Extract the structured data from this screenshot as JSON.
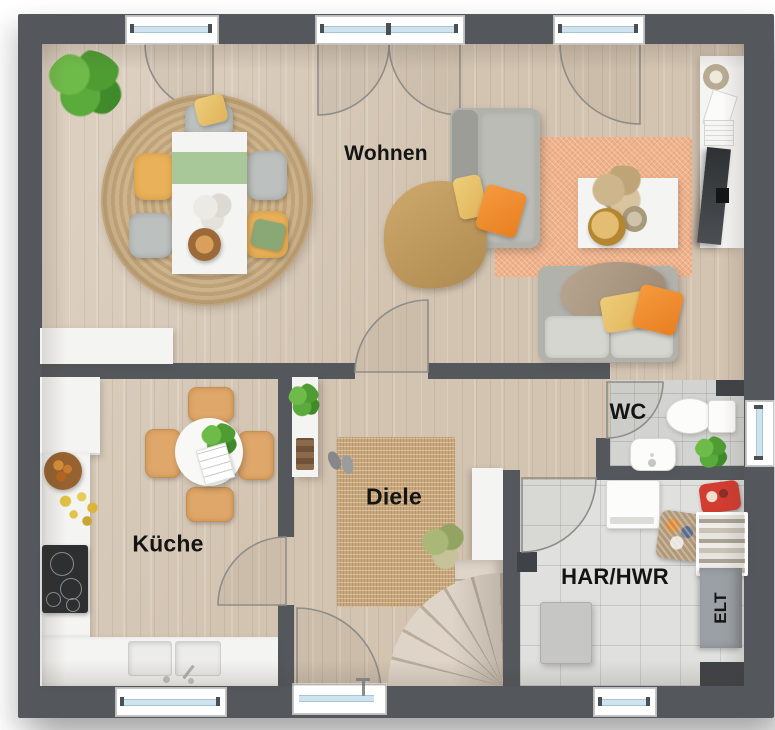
{
  "plan": {
    "type": "floor-plan",
    "rooms": {
      "wohnen": {
        "label": "Wohnen"
      },
      "kueche": {
        "label": "Küche"
      },
      "diele": {
        "label": "Diele"
      },
      "wc": {
        "label": "WC"
      },
      "har_hwr": {
        "label": "HAR/HWR"
      },
      "elt": {
        "label": "ELT"
      }
    },
    "colors": {
      "wall": "#54585d",
      "wood_floor": "#d3c4b2",
      "tile_floor": "#e0e1df",
      "wc_tile": "#d3d4d2",
      "window_glass": "#cfe3ee",
      "rug_salmon": "#efb28b",
      "rug_jute": "#c9a87c",
      "accent_orange": "#ef8f35",
      "accent_yellow": "#e9b159",
      "accent_green": "#a9c89a",
      "label_color": "#141414"
    },
    "furniture": [
      "palm-plant",
      "round-rug",
      "dining-table",
      "dining-chairs",
      "dining-sideboard",
      "chaise-sofa",
      "two-seat-sofa",
      "throw-blanket",
      "area-rug",
      "coffee-table",
      "tv-lowboard",
      "tv",
      "french-door",
      "terrace-doors",
      "fridge",
      "kitchen-counter",
      "cooktop",
      "kitchen-sink",
      "kitchen-table",
      "kitchen-chairs",
      "shoe-cabinet",
      "hall-rug",
      "slippers",
      "staircase",
      "stair-plant",
      "toilet",
      "washbasin",
      "wc-plant",
      "washing-machine",
      "laundry-basket",
      "utility-shelf",
      "cleaning-caddy",
      "boiler",
      "elt-cabinet",
      "front-door"
    ]
  }
}
